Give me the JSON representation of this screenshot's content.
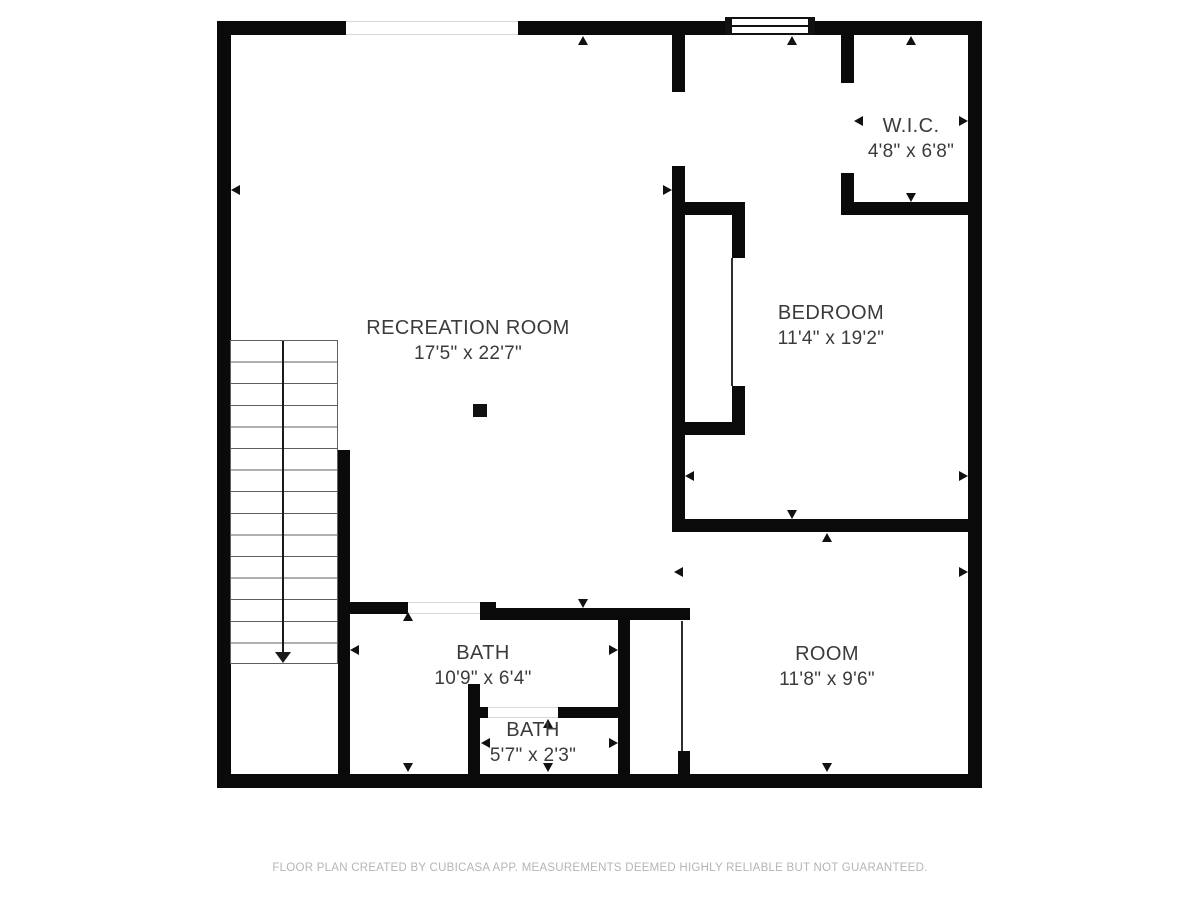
{
  "rooms": {
    "recreation": {
      "name": "RECREATION ROOM",
      "dims": "17'5\" x 22'7\""
    },
    "bedroom": {
      "name": "BEDROOM",
      "dims": "11'4\" x 19'2\""
    },
    "wic": {
      "name": "W.I.C.",
      "dims": "4'8\" x 6'8\""
    },
    "bath": {
      "name": "BATH",
      "dims": "10'9\" x 6'4\""
    },
    "bath_small": {
      "name": "BATH",
      "dims": "5'7\" x 2'3\""
    },
    "room": {
      "name": "ROOM",
      "dims": "11'8\" x 9'6\""
    }
  },
  "footer": {
    "text": "FLOOR PLAN CREATED BY CUBICASA APP. MEASUREMENTS DEEMED HIGHLY RELIABLE BUT NOT GUARANTEED."
  },
  "colors": {
    "wall": "#0a0a0a",
    "label_text": "#3b3b3b",
    "footer_text": "#b5b5b5",
    "stair_line": "#5f5f5f",
    "opening_line": "#d9d9d9"
  }
}
